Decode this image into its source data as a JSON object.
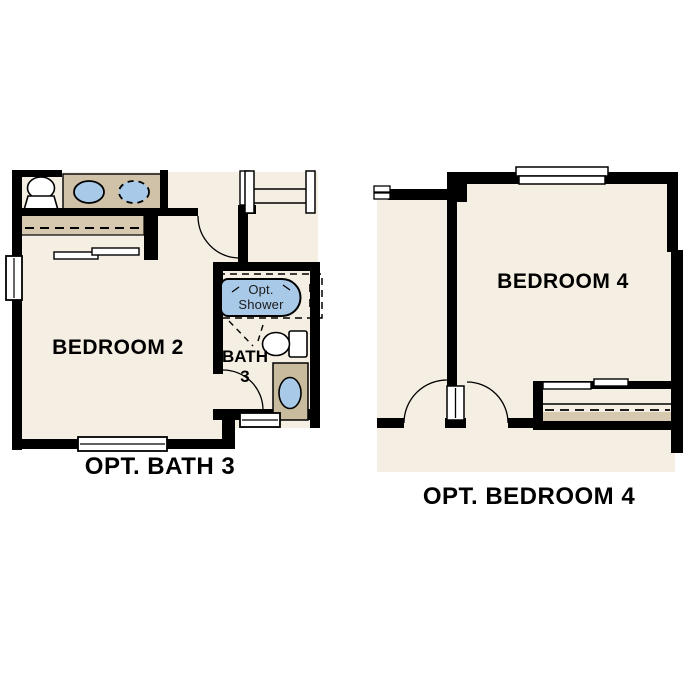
{
  "document_type": "floor-plan-options-sheet",
  "colors": {
    "background": "#ffffff",
    "floor": "#f5eee2",
    "cabinet_tan": "#cfc2a8",
    "closet_tan": "#d6c9b0",
    "fixture_blue": "#a9c9e8",
    "wall": "#000000",
    "text": "#000000"
  },
  "plans": [
    {
      "caption": "OPT. BATH 3",
      "rooms": [
        {
          "label": "BEDROOM 2"
        },
        {
          "label_line1": "BATH",
          "label_line2": "3"
        }
      ],
      "shower_note": {
        "line1": "Opt.",
        "line2": "Shower"
      },
      "fixtures": [
        "toilet-icon",
        "sink-icon",
        "optional-sink-icon",
        "closet-sliding-doors",
        "optional-shower-tub-icon",
        "toilet-icon",
        "vanity-sink-icon",
        "window",
        "door-swing",
        "stair-railing"
      ]
    },
    {
      "caption": "OPT. BEDROOM 4",
      "rooms": [
        {
          "label": "BEDROOM 4"
        }
      ],
      "fixtures": [
        "window",
        "double-door-swing",
        "sliding-door-closet",
        "wall-break-icon"
      ]
    }
  ]
}
